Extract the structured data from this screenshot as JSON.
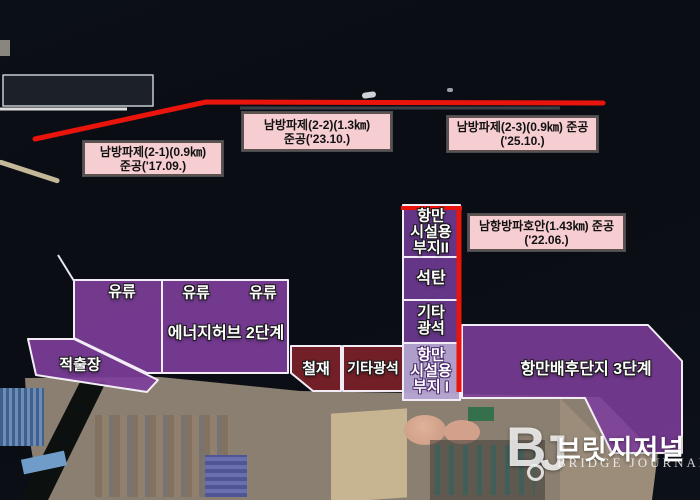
{
  "annotations": {
    "breakwaters": [
      {
        "id": "nambang-2-1",
        "line1": "남방파제(2-1)(0.9㎞)",
        "line2": "준공('17.09.)"
      },
      {
        "id": "nambang-2-2",
        "line1": "남방파제(2-2)(1.3㎞)",
        "line2": "준공('23.10.)"
      },
      {
        "id": "nambang-2-3",
        "line1": "남방파제(2-3)(0.9㎞) 준공",
        "line2": "('25.10.)"
      },
      {
        "id": "namhang-hoan",
        "line1": "남항방파호안(1.43㎞) 준공",
        "line2": "('22.06.)"
      }
    ],
    "zones": {
      "oil1": "유류",
      "oil2": "유류",
      "oil3": "유류",
      "energy_hub": "에너지허브 2단계",
      "jeokchuljang": "적출장",
      "steel": "철재",
      "other_ore": "기타광석",
      "coal": "석탄",
      "strip_site2": [
        "항만",
        "시설용",
        "부지II"
      ],
      "strip_other_ore": [
        "기타",
        "광석"
      ],
      "strip_site1": [
        "항만",
        "시설용",
        "부지 I"
      ],
      "hinterland": "항만배후단지 3단계"
    }
  },
  "watermark": {
    "monogram_b": "B",
    "monogram_j": "J",
    "brand_kr": "브릿지저널",
    "brand_en": "BRIDGE JOURNAL"
  },
  "colors": {
    "zone_purple": "#7d3e9b",
    "zone_purple_light": "#b7a6d3",
    "zone_maroon": "#7d2129",
    "red_line": "#e9140c",
    "label_pink": "#f6cdd1",
    "border_white": "#f2ecf6"
  }
}
